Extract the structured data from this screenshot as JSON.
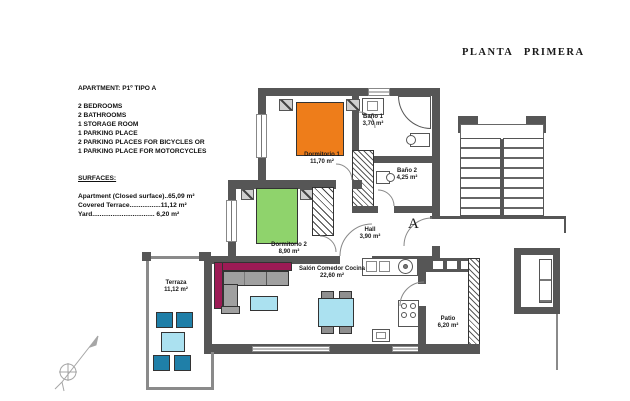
{
  "title": "PLANTA PRIMERA",
  "unit_label": "A",
  "info": {
    "heading": "APARTMENT: P1º TIPO A",
    "features": [
      "2 BEDROOMS",
      "2 BATHROOMS",
      "1 STORAGE ROOM",
      "1 PARKING PLACE",
      "2 PARKING PLACES FOR BICYCLES OR",
      "1 PARKING PLACE FOR MOTORCYCLES"
    ],
    "surfaces_heading": "SURFACES:",
    "surfaces": [
      "Apartment (Closed surface)..65,09 m²",
      "Covered Terrace.................11,12 m²",
      "Yard.................................. 6,20 m²"
    ]
  },
  "rooms": {
    "dormitorio1": {
      "name": "Dormitorio 1",
      "area": "11,70 m²"
    },
    "bano1": {
      "name": "Baño 1",
      "area": "3,70 m²"
    },
    "bano2": {
      "name": "Baño 2",
      "area": "4,25 m²"
    },
    "dormitorio2": {
      "name": "Dormitorio 2",
      "area": "8,90 m²"
    },
    "hall": {
      "name": "Hall",
      "area": "3,90 m²"
    },
    "salon": {
      "name": "Salón Comedor Cocina",
      "area": "22,60 m²"
    },
    "terraza": {
      "name": "Terraza",
      "area": "11,12 m²"
    },
    "patio": {
      "name": "Patio",
      "area": "6,20 m²"
    }
  },
  "colors": {
    "bed1_orange": "#EE7D1A",
    "bed2_green": "#8FD36C",
    "sofa_back_magenta": "#9C1B55",
    "table_light_blue": "#ABE1F0",
    "terrace_chair_teal": "#1F7FA8",
    "wall_gray": "#565656"
  }
}
